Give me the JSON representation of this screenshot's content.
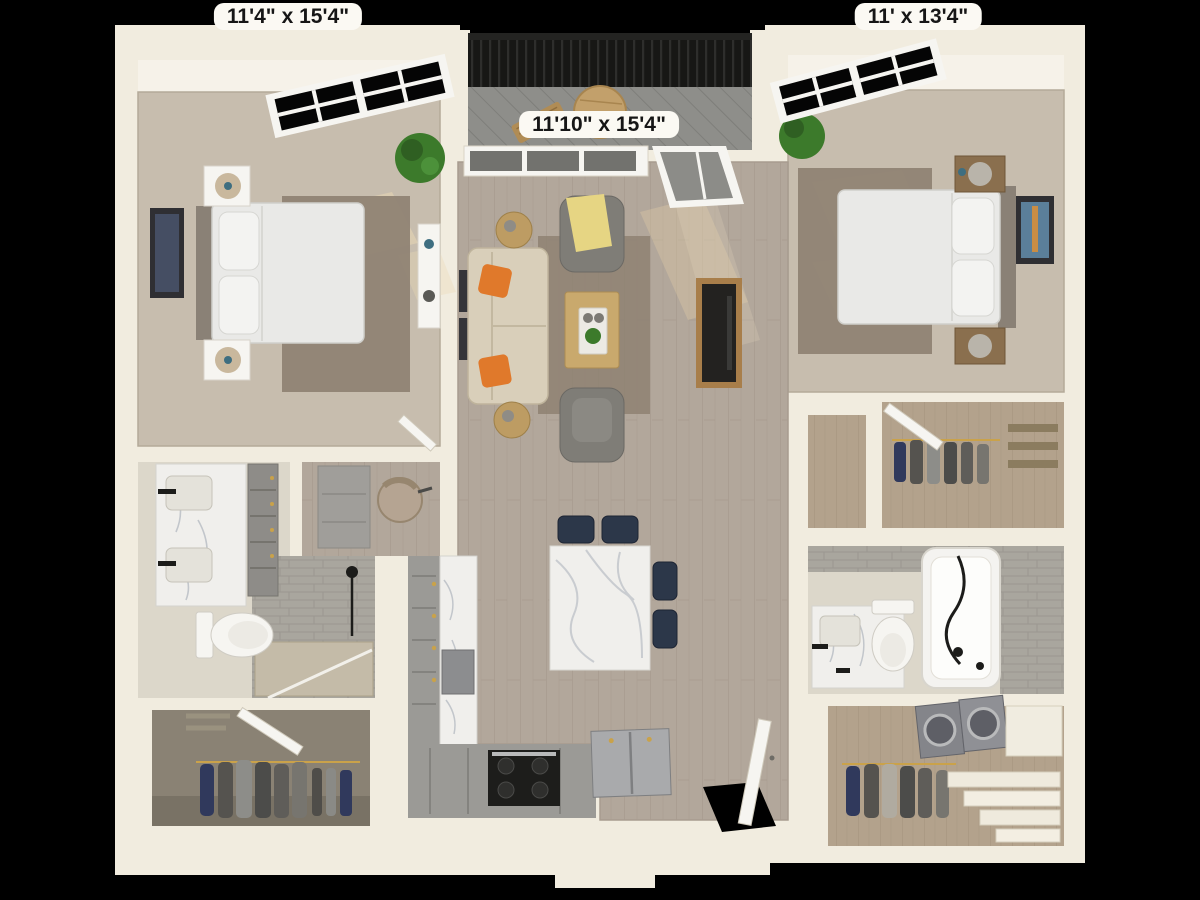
{
  "labels": {
    "bedroom_left": "11'4\" x 15'4\"",
    "living": "11'10\" x 15'4\"",
    "bedroom_right": "11' x 13'4\""
  },
  "palette": {
    "bg": "#000000",
    "wall": "#f1ecdf",
    "wall-shade": "#ddd5c2",
    "wall-face": "#f6f2e9",
    "carpet": "#c7bdae",
    "rug": "#8e8172",
    "wood": "#b2a79b",
    "wood-line": "#a1968a",
    "tan": "#b3a28c",
    "tile": "#a9a69e",
    "tile-line": "#97948c",
    "bathfloor": "#dcd7ca",
    "marble": "#f0efec",
    "vein": "#c2c6cb",
    "navy": "#2c3749",
    "orange": "#e0792b",
    "yellow": "#e6d583",
    "sofa": "#d9cfba",
    "chair": "#7f7d77",
    "woodfurn": "#c9a96d",
    "dark": "#232220",
    "plant": "#3c7a2b",
    "deck": "#8e8e8a",
    "railing": "#171715",
    "steel": "#9fa0a0",
    "white": "#f6f5f1",
    "closet-carpet": "#8a8274",
    "garment": "#4c4c4a",
    "garment-navy": "#30395c",
    "label-bg": "#fbf9f3",
    "label-text": "#161616"
  }
}
